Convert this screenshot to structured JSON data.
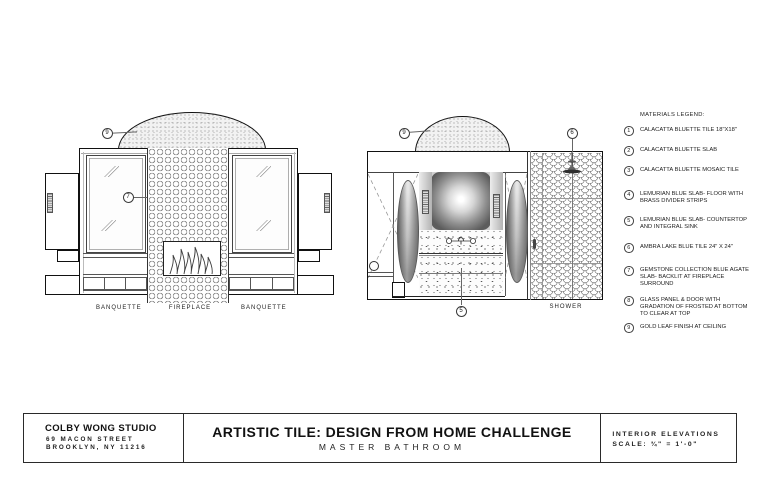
{
  "sheet": {
    "paper_color": "#ffffff",
    "ink_color": "#1a1a1a",
    "line_gray": "#888888"
  },
  "legend": {
    "title": "MATERIALS LEGEND:",
    "items": [
      {
        "num": "1",
        "lines": [
          "CALACATTA BLUETTE TILE 18\"X18\""
        ]
      },
      {
        "num": "2",
        "lines": [
          "CALACATTA BLUETTE SLAB"
        ]
      },
      {
        "num": "3",
        "lines": [
          "CALACATTA BLUETTE MOSAIC TILE"
        ]
      },
      {
        "num": "4",
        "lines": [
          "LEMURIAN BLUE SLAB- FLOOR WITH",
          "BRASS DIVIDER STRIPS"
        ]
      },
      {
        "num": "5",
        "lines": [
          "LEMURIAN BLUE SLAB- COUNTERTOP",
          "AND INTEGRAL SINK"
        ]
      },
      {
        "num": "6",
        "lines": [
          "AMBRA LAKE BLUE TILE 24\" X 24\""
        ]
      },
      {
        "num": "7",
        "lines": [
          "GEMSTONE COLLECTION BLUE AGATE",
          "SLAB- BACKLIT AT FIREPLACE",
          "SURROUND"
        ]
      },
      {
        "num": "8",
        "lines": [
          "GLASS PANEL & DOOR WITH",
          "GRADATION OF FROSTED AT BOTTOM",
          "TO CLEAR AT TOP"
        ]
      },
      {
        "num": "9",
        "lines": [
          "GOLD LEAF FINISH AT CEILING"
        ]
      }
    ]
  },
  "elevation_left": {
    "labels": {
      "banquette_left": "BANQUETTE",
      "fireplace": "FIREPLACE",
      "banquette_right": "BANQUETTE"
    },
    "callouts": {
      "ceiling": "9",
      "fireplace_surround": "7"
    }
  },
  "elevation_right": {
    "labels": {
      "shower": "SHOWER"
    },
    "callouts": {
      "ceiling": "9",
      "shower_tile": "6",
      "vanity": "5"
    }
  },
  "title_block": {
    "studio": {
      "name": "COLBY WONG STUDIO",
      "address_line1": "69 MACON STREET",
      "address_line2": "BROOKLYN, NY 11216"
    },
    "title": "ARTISTIC TILE: DESIGN FROM HOME CHALLENGE",
    "subtitle": "MASTER BATHROOM",
    "sheet_info": {
      "type": "INTERIOR ELEVATIONS",
      "scale": "SCALE: ¾\" = 1'-0\""
    }
  }
}
